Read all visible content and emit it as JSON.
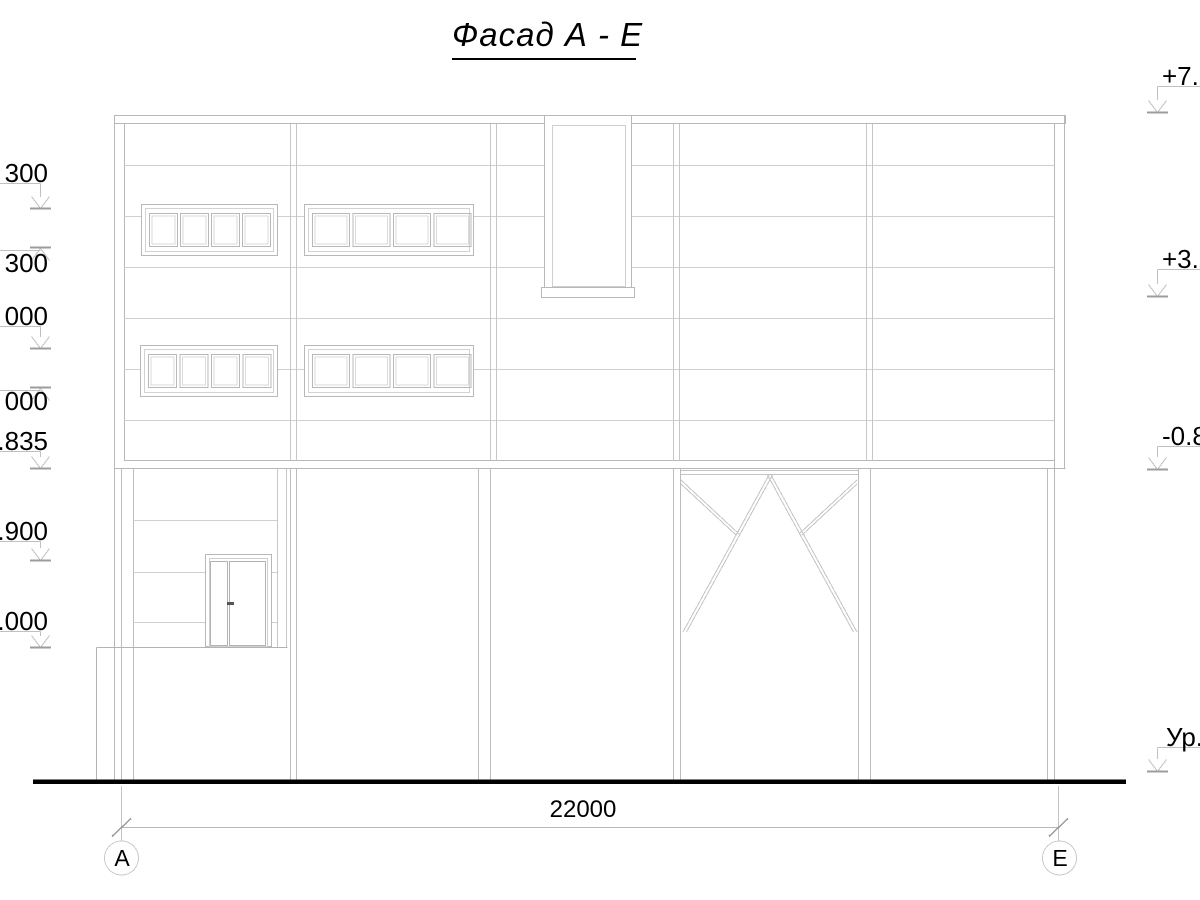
{
  "title": "Фасад А - Е",
  "marks_left": [
    {
      "text": "300"
    },
    {
      "text": "300"
    },
    {
      "text": "000"
    },
    {
      "text": "000"
    },
    {
      "text": ".835"
    },
    {
      "text": ".900"
    },
    {
      "text": ".000"
    }
  ],
  "marks_right": [
    {
      "text": "+7.50"
    },
    {
      "text": "+3.30"
    },
    {
      "text": "-0.83"
    },
    {
      "text": "Ур."
    }
  ],
  "dimension": {
    "total": "22000"
  },
  "axis_bubbles": [
    {
      "label": "А"
    },
    {
      "label": "Е"
    }
  ],
  "colors": {
    "line_light": "#cfcfcf",
    "line_medium": "#b8b8b8",
    "tick": "#a0a0a0",
    "ground": "#000000"
  }
}
